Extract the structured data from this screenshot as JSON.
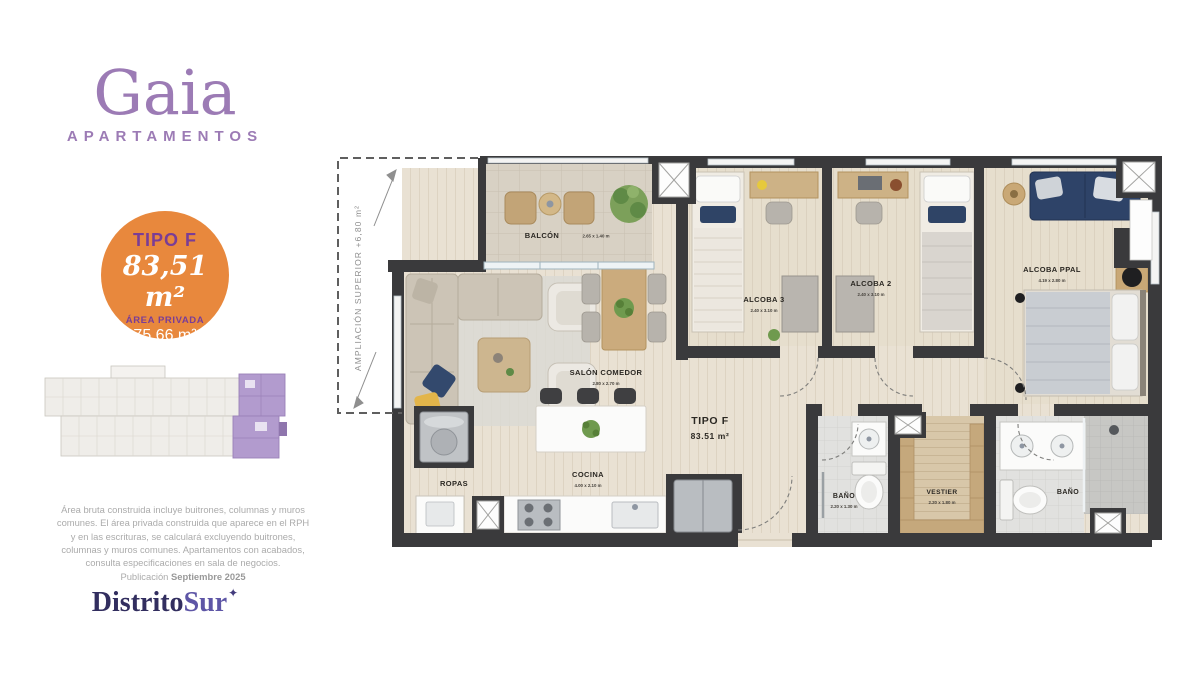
{
  "brand": {
    "name": "Gaia",
    "subtitle": "APARTAMENTOS"
  },
  "badge": {
    "type": "TIPO F",
    "total_area": "83,51 m²",
    "private_area_label": "ÁREA PRIVADA",
    "private_area": "75,66 m²"
  },
  "legal": {
    "lines": [
      "Área bruta construida incluye buitrones, columnas y muros",
      "comunes. El área privada construida que aparece en el RPH",
      "y en las escrituras, se calculará  excluyendo buitrones,",
      "columnas y muros comunes. Apartamentos con acabados,",
      "consulta especificaciones en sala de negocios."
    ],
    "publication_prefix": "Publicación ",
    "publication_date": "Septiembre 2025"
  },
  "developer": {
    "name_part1": "Distrito",
    "name_part2": "Sur",
    "star": "✦"
  },
  "plan": {
    "annotation": "AMPLIACIÓN SUPERIOR +6,80 m²",
    "unit": {
      "label": "TIPO F",
      "area": "83.51 m²"
    },
    "rooms": {
      "balcon": {
        "name": "BALCÓN",
        "dims": "2.65 x 1.40 m"
      },
      "salon": {
        "name": "SALÓN COMEDOR",
        "dims": "2.80 x 2.70 m"
      },
      "cocina": {
        "name": "COCINA",
        "dims": "4.00 x 2.10 m"
      },
      "ropas": {
        "name": "ROPAS",
        "dims": ""
      },
      "alcoba3": {
        "name": "ALCOBA 3",
        "dims": "2.40 x 3.10 m"
      },
      "alcoba2": {
        "name": "ALCOBA 2",
        "dims": "2.40 x 3.10 m"
      },
      "alcoba_ppal": {
        "name": "ALCOBA PPAL",
        "dims": "4.19 x 2.80 m"
      },
      "bano1": {
        "name": "BAÑO",
        "dims": "2.20 x 1.30 m"
      },
      "vestier": {
        "name": "VESTIER",
        "dims": "2.20 x 1.80 m"
      },
      "bano2": {
        "name": "BAÑO",
        "dims": ""
      }
    }
  },
  "colors": {
    "brand_purple": "#9c7bb5",
    "badge_orange": "#e8883d",
    "badge_purple": "#7a3d96",
    "developer_navy": "#322e5f",
    "developer_purple": "#5e56a6",
    "wall": "#3a3a3c",
    "keyplan_highlight": "#b29bce"
  }
}
